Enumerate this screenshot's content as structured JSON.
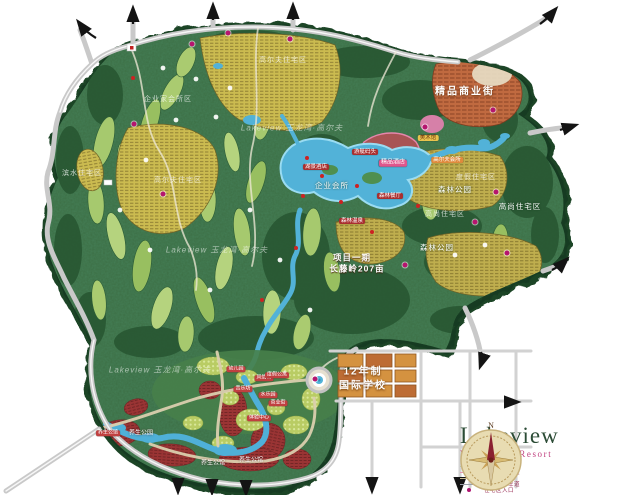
{
  "logo": {
    "brand": "Lakeview",
    "subtitle": "Yulongwan Resort"
  },
  "compass": {
    "north": "N"
  },
  "legend": {
    "items": [
      {
        "swatch": "line",
        "color": "#b8c4a8",
        "label": "丛林漫步道"
      },
      {
        "swatch": "line",
        "color": "#e896b4",
        "label": "溪谷亲水栈道"
      },
      {
        "swatch": "line",
        "color": "#c8b890",
        "label": "马道"
      },
      {
        "swatch": "line",
        "color": "#9aa0a8",
        "label": "山地自行车道"
      },
      {
        "swatch": "dot",
        "color": "#ad1570",
        "label": "住宅区入口"
      }
    ]
  },
  "map": {
    "watermark_text": "Lakeview 玉龙湾·高尔夫",
    "watermarks": [
      {
        "x": 292,
        "y": 128
      },
      {
        "x": 217,
        "y": 250
      },
      {
        "x": 160,
        "y": 370
      }
    ],
    "entrance_dot_color": "#b5156e",
    "entrance_dots": [
      [
        192,
        44
      ],
      [
        228,
        33
      ],
      [
        290,
        39
      ],
      [
        134,
        124
      ],
      [
        163,
        194
      ],
      [
        425,
        127
      ],
      [
        493,
        110
      ],
      [
        496,
        192
      ],
      [
        475,
        222
      ],
      [
        507,
        253
      ],
      [
        405,
        265
      ],
      [
        315,
        379
      ]
    ],
    "labels": [
      {
        "x": 283,
        "y": 61,
        "text": "高尔夫住宅区",
        "kind": "faint"
      },
      {
        "x": 168,
        "y": 100,
        "text": "企业家会所区",
        "kind": "faint"
      },
      {
        "x": 82,
        "y": 174,
        "text": "滨水住宅区",
        "kind": "faint"
      },
      {
        "x": 178,
        "y": 181,
        "text": "高尔夫住宅区",
        "kind": "faint"
      },
      {
        "x": 476,
        "y": 178,
        "text": "度假住宅区",
        "kind": "faint"
      },
      {
        "x": 445,
        "y": 215,
        "text": "高尚住宅区",
        "kind": "faint"
      },
      {
        "x": 520,
        "y": 207,
        "text": "高尚住宅区",
        "kind": "white"
      },
      {
        "x": 332,
        "y": 186,
        "text": "企业会所",
        "kind": "white"
      },
      {
        "x": 455,
        "y": 190,
        "text": "森林公园",
        "kind": "white"
      },
      {
        "x": 437,
        "y": 248,
        "text": "森林公园",
        "kind": "white"
      },
      {
        "x": 352,
        "y": 258,
        "text": "项目一期",
        "kind": "white-bold"
      },
      {
        "x": 357,
        "y": 269,
        "text": "长藤岭207亩",
        "kind": "white-bold"
      },
      {
        "x": 465,
        "y": 92,
        "text": "精品商业街",
        "kind": "white-lg"
      },
      {
        "x": 363,
        "y": 372,
        "text": "12年制",
        "kind": "white-lg"
      },
      {
        "x": 363,
        "y": 386,
        "text": "国际学校",
        "kind": "white-lg"
      },
      {
        "x": 393,
        "y": 163,
        "text": "精品酒店",
        "kind": "pill-pink"
      },
      {
        "x": 428,
        "y": 138,
        "text": "美术馆",
        "kind": "pill-yellow"
      },
      {
        "x": 447,
        "y": 160,
        "text": "高尔夫会所",
        "kind": "pill-orange"
      },
      {
        "x": 316,
        "y": 167,
        "text": "湖景酒店",
        "kind": "pill-red"
      },
      {
        "x": 365,
        "y": 152,
        "text": "游艇码头",
        "kind": "pill-red"
      },
      {
        "x": 390,
        "y": 196,
        "text": "森林餐厅",
        "kind": "pill-red"
      },
      {
        "x": 352,
        "y": 221,
        "text": "森林温泉",
        "kind": "pill-red"
      },
      {
        "x": 236,
        "y": 369,
        "text": "幼儿园",
        "kind": "pill-red-sm"
      },
      {
        "x": 264,
        "y": 378,
        "text": "风情街",
        "kind": "pill-red-sm"
      },
      {
        "x": 277,
        "y": 375,
        "text": "度假公寓",
        "kind": "pill-red-sm"
      },
      {
        "x": 243,
        "y": 389,
        "text": "音乐坊",
        "kind": "pill-red-sm"
      },
      {
        "x": 268,
        "y": 395,
        "text": "水乐园",
        "kind": "pill-red-sm"
      },
      {
        "x": 278,
        "y": 403,
        "text": "商业街",
        "kind": "pill-red-sm"
      },
      {
        "x": 259,
        "y": 418,
        "text": "体验中心",
        "kind": "pill-red-sm"
      },
      {
        "x": 108,
        "y": 433,
        "text": "养生公馆",
        "kind": "pill-red-sm"
      },
      {
        "x": 141,
        "y": 434,
        "text": "养生公园",
        "kind": "white-sm"
      },
      {
        "x": 213,
        "y": 464,
        "text": "养生公馆",
        "kind": "white-sm"
      },
      {
        "x": 251,
        "y": 461,
        "text": "养生公馆",
        "kind": "white-sm"
      }
    ]
  }
}
